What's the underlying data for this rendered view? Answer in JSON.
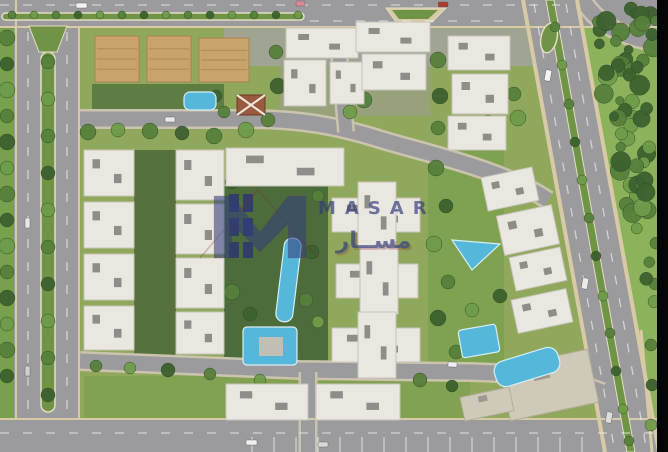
{
  "title": "Residential compound aerial masterplan render",
  "watermark": {
    "brand_en": "MASAR",
    "brand_ar": "مســار",
    "color": "#333d7d",
    "accent": "#8a2430"
  },
  "palette": {
    "asphalt": "#9b9b9d",
    "casing": "#cbc3ad",
    "sidewalk": "#d9caa6",
    "median": "#6f9446",
    "medianEdge": "#e4dcc6",
    "treeDark": "#3d612f",
    "treeMid": "#57803c",
    "treeLight": "#6f9c4a",
    "building": "#e9e7e0",
    "buildingEdge": "#c6c3ba",
    "roofUnit": "#8f8d87",
    "tanRoof": "#c9a36b",
    "tanEdge": "#a9854d",
    "flatRoof": "#cfc9ba",
    "flatEdge": "#b5ad9a",
    "pool": "#55b8da",
    "poolEdge": "#d6eef5",
    "deck": "#c2beb4",
    "cabana": "#2f3a6d",
    "pavilion": "#9a5a40",
    "black": "#050505"
  },
  "scene": {
    "ground": {
      "base": "#90a85c",
      "patches": [
        {
          "x": 0,
          "y": 27,
          "w": 16,
          "h": 393,
          "f": "#79a04c"
        },
        {
          "x": 224,
          "y": 20,
          "w": 312,
          "h": 46,
          "f": "#a3a39b",
          "o": 0.85
        },
        {
          "x": 280,
          "y": 60,
          "w": 150,
          "h": 56,
          "f": "#9c9c94",
          "o": 0.55
        },
        {
          "x": 224,
          "y": 186,
          "w": 104,
          "h": 182,
          "f": "#4d6c3b"
        },
        {
          "x": 92,
          "y": 84,
          "w": 132,
          "h": 36,
          "f": "#5d7d44"
        },
        {
          "x": 134,
          "y": 150,
          "w": 42,
          "h": 206,
          "f": "#56713d"
        },
        {
          "x": 84,
          "y": 376,
          "w": 386,
          "h": 42,
          "f": "#83a251"
        },
        {
          "x": 428,
          "y": 148,
          "w": 76,
          "h": 224,
          "f": "#7ea24f"
        }
      ]
    },
    "rightLawn": {
      "pts": "578,0 668,0 668,452 658,452",
      "f": "#8cb35c"
    },
    "roads": {
      "rects": [
        {
          "x": 0,
          "y": 0,
          "w": 668,
          "h": 26
        },
        {
          "x": 14,
          "y": 0,
          "w": 66,
          "h": 452
        },
        {
          "x": 0,
          "y": 420,
          "w": 668,
          "h": 32
        }
      ],
      "polys": [
        {
          "pts": "522,0 578,0 660,452 604,452"
        }
      ],
      "paths": [
        {
          "d": "M80,119 H246 C304,119 340,127 376,138 C420,152 500,168 548,200",
          "w": 15
        },
        {
          "d": "M80,361 L300,370 L470,372 C538,374 572,380 602,392",
          "w": 15
        },
        {
          "d": "M339,52 L346,132",
          "w": 13
        },
        {
          "d": "M308,372 L308,452",
          "w": 14
        },
        {
          "d": "M584,2 C600,26 626,40 668,44",
          "w": 15
        }
      ]
    },
    "sidewalks": [
      {
        "x1": 0,
        "y1": 27,
        "x2": 668,
        "y2": 27,
        "w": 2
      },
      {
        "x1": 16,
        "y1": 0,
        "x2": 16,
        "y2": 420,
        "w": 2
      },
      {
        "x1": 79,
        "y1": 27,
        "x2": 79,
        "y2": 420,
        "w": 2
      },
      {
        "x1": 0,
        "y1": 419,
        "x2": 668,
        "y2": 419,
        "w": 2
      },
      {
        "x1": 523,
        "y1": 0,
        "x2": 605,
        "y2": 452,
        "w": 4
      },
      {
        "x1": 577,
        "y1": 0,
        "x2": 659,
        "y2": 452,
        "w": 4
      },
      {
        "x1": 641,
        "y1": 330,
        "x2": 652,
        "y2": 452,
        "w": 3
      }
    ],
    "medians": {
      "rects": [
        {
          "x": 41,
          "y": 52,
          "w": 14,
          "h": 360,
          "rx": 7
        },
        {
          "x": 2,
          "y": 13,
          "w": 302,
          "h": 7,
          "rx": 3.5
        }
      ],
      "polys": [
        {
          "pts": "546,0 554,0 635,452 627,452"
        },
        {
          "pts": "29,26 67,26 57,52 39,52"
        }
      ],
      "island": {
        "outer": "386,8 446,8 432,22 396,22",
        "inner": "392,10 438,10 428,19 399,19"
      },
      "teardrop": {
        "cx": 549,
        "cy": 38,
        "rx": 8,
        "ry": 15,
        "rot": 12
      }
    },
    "dashes": [
      {
        "x1": 0,
        "y1": 5,
        "x2": 560,
        "y2": 5
      },
      {
        "x1": 310,
        "y1": 21,
        "x2": 505,
        "y2": 21
      },
      {
        "x1": 28,
        "y1": 32,
        "x2": 28,
        "y2": 414
      },
      {
        "x1": 67,
        "y1": 32,
        "x2": 67,
        "y2": 414
      },
      {
        "x1": 0,
        "y1": 433,
        "x2": 668,
        "y2": 433
      },
      {
        "x1": 534,
        "y1": 4,
        "x2": 615,
        "y2": 452
      },
      {
        "x1": 566,
        "y1": 4,
        "x2": 647,
        "y2": 452
      }
    ],
    "parking": {
      "x0": 252,
      "step": 22,
      "n": 16,
      "y1": 437,
      "y2": 452
    },
    "trees": [
      [
        7,
        38,
        8,
        1
      ],
      [
        7,
        64,
        7,
        0
      ],
      [
        7,
        90,
        8,
        2
      ],
      [
        7,
        116,
        7,
        1
      ],
      [
        7,
        142,
        8,
        0
      ],
      [
        7,
        168,
        7,
        2
      ],
      [
        7,
        194,
        8,
        1
      ],
      [
        7,
        220,
        7,
        0
      ],
      [
        7,
        246,
        8,
        2
      ],
      [
        7,
        272,
        7,
        1
      ],
      [
        7,
        298,
        8,
        0
      ],
      [
        7,
        324,
        7,
        2
      ],
      [
        7,
        350,
        8,
        1
      ],
      [
        7,
        376,
        7,
        0
      ],
      [
        48,
        62,
        7,
        1
      ],
      [
        48,
        99,
        7,
        2
      ],
      [
        48,
        136,
        7,
        1
      ],
      [
        48,
        173,
        7,
        0
      ],
      [
        48,
        210,
        7,
        2
      ],
      [
        48,
        247,
        7,
        1
      ],
      [
        48,
        284,
        7,
        0
      ],
      [
        48,
        321,
        7,
        2
      ],
      [
        48,
        358,
        7,
        1
      ],
      [
        48,
        395,
        7,
        0
      ],
      [
        12,
        15,
        4,
        1
      ],
      [
        34,
        15,
        4,
        2
      ],
      [
        56,
        15,
        4,
        1
      ],
      [
        78,
        15,
        4,
        0
      ],
      [
        100,
        15,
        4,
        2
      ],
      [
        122,
        15,
        4,
        1
      ],
      [
        144,
        15,
        4,
        0
      ],
      [
        166,
        15,
        4,
        2
      ],
      [
        188,
        15,
        4,
        1
      ],
      [
        210,
        15,
        4,
        0
      ],
      [
        232,
        15,
        4,
        2
      ],
      [
        254,
        15,
        4,
        1
      ],
      [
        276,
        15,
        4,
        0
      ],
      [
        298,
        15,
        4,
        2
      ],
      [
        555,
        27,
        5,
        1
      ],
      [
        562,
        65,
        5,
        2
      ],
      [
        569,
        104,
        5,
        1
      ],
      [
        575,
        142,
        5,
        0
      ],
      [
        582,
        180,
        5,
        2
      ],
      [
        589,
        218,
        5,
        1
      ],
      [
        596,
        256,
        5,
        0
      ],
      [
        603,
        296,
        5,
        2
      ],
      [
        610,
        333,
        5,
        1
      ],
      [
        616,
        371,
        5,
        0
      ],
      [
        623,
        409,
        5,
        2
      ],
      [
        629,
        441,
        5,
        1
      ],
      [
        88,
        132,
        8,
        1
      ],
      [
        118,
        130,
        7,
        2
      ],
      [
        150,
        131,
        8,
        1
      ],
      [
        182,
        133,
        7,
        0
      ],
      [
        214,
        136,
        8,
        1
      ],
      [
        246,
        130,
        8,
        2
      ],
      [
        268,
        120,
        7,
        1
      ],
      [
        258,
        106,
        6,
        0
      ],
      [
        276,
        52,
        7,
        1
      ],
      [
        278,
        86,
        8,
        0
      ],
      [
        364,
        100,
        8,
        1
      ],
      [
        350,
        112,
        7,
        2
      ],
      [
        438,
        60,
        8,
        1
      ],
      [
        440,
        96,
        8,
        0
      ],
      [
        438,
        128,
        7,
        1
      ],
      [
        518,
        118,
        8,
        2
      ],
      [
        514,
        94,
        7,
        1
      ],
      [
        488,
        122,
        7,
        0
      ],
      [
        474,
        88,
        7,
        2
      ],
      [
        232,
        182,
        7,
        0
      ],
      [
        318,
        196,
        6,
        1
      ],
      [
        312,
        252,
        7,
        0
      ],
      [
        306,
        300,
        7,
        1
      ],
      [
        250,
        314,
        7,
        0
      ],
      [
        232,
        292,
        8,
        1
      ],
      [
        318,
        322,
        6,
        2
      ],
      [
        436,
        168,
        8,
        1
      ],
      [
        446,
        206,
        7,
        0
      ],
      [
        434,
        244,
        8,
        2
      ],
      [
        448,
        282,
        7,
        1
      ],
      [
        438,
        318,
        8,
        0
      ],
      [
        456,
        352,
        7,
        1
      ],
      [
        472,
        310,
        7,
        2
      ],
      [
        500,
        296,
        7,
        0
      ],
      [
        96,
        366,
        6,
        1
      ],
      [
        130,
        368,
        6,
        2
      ],
      [
        168,
        370,
        7,
        0
      ],
      [
        210,
        374,
        6,
        1
      ],
      [
        260,
        380,
        6,
        2
      ],
      [
        420,
        380,
        7,
        1
      ],
      [
        452,
        386,
        6,
        0
      ],
      [
        651,
        345,
        6,
        1
      ],
      [
        652,
        385,
        6,
        0
      ],
      [
        651,
        425,
        6,
        2
      ],
      [
        216,
        96,
        6,
        0
      ],
      [
        224,
        112,
        6,
        1
      ]
    ],
    "forest": {
      "poly": [
        [
          586,
          8
        ],
        [
          656,
          8
        ],
        [
          656,
          328
        ],
        [
          626,
          210
        ],
        [
          596,
          70
        ]
      ],
      "count": 64,
      "seed": 9,
      "rmin": 4,
      "rmax": 10
    },
    "buildings": [
      {
        "x": 95,
        "y": 36,
        "w": 44,
        "h": 46,
        "s": "t"
      },
      {
        "x": 147,
        "y": 36,
        "w": 44,
        "h": 46,
        "s": "t"
      },
      {
        "x": 199,
        "y": 38,
        "w": 50,
        "h": 44,
        "s": "t"
      },
      {
        "x": 286,
        "y": 28,
        "w": 72,
        "h": 30,
        "s": "w"
      },
      {
        "x": 284,
        "y": 60,
        "w": 42,
        "h": 46,
        "s": "w"
      },
      {
        "x": 330,
        "y": 62,
        "w": 34,
        "h": 42,
        "s": "w"
      },
      {
        "x": 356,
        "y": 22,
        "w": 74,
        "h": 30,
        "s": "w"
      },
      {
        "x": 362,
        "y": 54,
        "w": 64,
        "h": 36,
        "s": "w"
      },
      {
        "x": 448,
        "y": 36,
        "w": 62,
        "h": 34,
        "s": "w"
      },
      {
        "x": 452,
        "y": 74,
        "w": 56,
        "h": 40,
        "s": "w"
      },
      {
        "x": 448,
        "y": 116,
        "w": 58,
        "h": 34,
        "s": "w"
      },
      {
        "x": 84,
        "y": 150,
        "w": 50,
        "h": 46,
        "s": "w"
      },
      {
        "x": 84,
        "y": 202,
        "w": 50,
        "h": 46,
        "s": "w"
      },
      {
        "x": 84,
        "y": 254,
        "w": 50,
        "h": 46,
        "s": "w"
      },
      {
        "x": 84,
        "y": 306,
        "w": 50,
        "h": 44,
        "s": "w"
      },
      {
        "x": 176,
        "y": 150,
        "w": 48,
        "h": 50,
        "s": "w"
      },
      {
        "x": 176,
        "y": 204,
        "w": 48,
        "h": 50,
        "s": "w"
      },
      {
        "x": 176,
        "y": 258,
        "w": 48,
        "h": 50,
        "s": "w"
      },
      {
        "x": 176,
        "y": 312,
        "w": 48,
        "h": 42,
        "s": "w"
      },
      {
        "x": 226,
        "y": 148,
        "w": 118,
        "h": 38,
        "s": "w"
      },
      {
        "x": 332,
        "y": 198,
        "w": 88,
        "h": 34,
        "s": "w"
      },
      {
        "x": 358,
        "y": 182,
        "w": 38,
        "h": 66,
        "s": "w"
      },
      {
        "x": 336,
        "y": 264,
        "w": 82,
        "h": 34,
        "s": "w"
      },
      {
        "x": 360,
        "y": 248,
        "w": 38,
        "h": 66,
        "s": "w"
      },
      {
        "x": 332,
        "y": 328,
        "w": 88,
        "h": 34,
        "s": "w"
      },
      {
        "x": 358,
        "y": 312,
        "w": 38,
        "h": 66,
        "s": "w"
      },
      {
        "x": 484,
        "y": 172,
        "w": 52,
        "h": 34,
        "s": "w",
        "rot": -12
      },
      {
        "x": 500,
        "y": 210,
        "w": 56,
        "h": 40,
        "s": "w",
        "rot": -12
      },
      {
        "x": 512,
        "y": 252,
        "w": 52,
        "h": 34,
        "s": "w",
        "rot": -12
      },
      {
        "x": 514,
        "y": 294,
        "w": 56,
        "h": 34,
        "s": "w",
        "rot": -12
      },
      {
        "x": 504,
        "y": 358,
        "w": 90,
        "h": 54,
        "s": "f",
        "rot": -12
      },
      {
        "x": 462,
        "y": 392,
        "w": 50,
        "h": 24,
        "s": "f",
        "rot": -12
      },
      {
        "x": 226,
        "y": 384,
        "w": 82,
        "h": 36,
        "s": "w"
      },
      {
        "x": 316,
        "y": 384,
        "w": 84,
        "h": 36,
        "s": "w"
      }
    ],
    "pools": [
      {
        "t": "r",
        "x": 184,
        "y": 92,
        "w": 32,
        "h": 18,
        "rx": 6
      },
      {
        "t": "r",
        "x": 280,
        "y": 238,
        "w": 17,
        "h": 84,
        "rx": 8,
        "rot": 7
      },
      {
        "t": "r",
        "x": 243,
        "y": 327,
        "w": 54,
        "h": 38,
        "rx": 4,
        "deck": {
          "x": 259,
          "y": 337,
          "w": 24,
          "h": 19
        }
      },
      {
        "t": "p",
        "pts": "452,240 500,244 472,270"
      },
      {
        "t": "r",
        "x": 460,
        "y": 327,
        "w": 38,
        "h": 28,
        "rx": 3,
        "rot": -10
      },
      {
        "t": "r",
        "x": 494,
        "y": 354,
        "w": 66,
        "h": 26,
        "rx": 10,
        "rot": -17
      }
    ],
    "cabanas": [
      [
        229,
        194,
        10,
        18
      ],
      [
        243,
        194,
        10,
        18
      ],
      [
        229,
        218,
        10,
        18
      ],
      [
        243,
        218,
        10,
        18
      ],
      [
        229,
        242,
        10,
        16
      ],
      [
        243,
        242,
        10,
        16
      ]
    ],
    "pavilion": {
      "x": 237,
      "y": 95,
      "w": 28,
      "h": 20
    },
    "cars": [
      [
        76,
        3,
        11,
        5,
        "#f2f2f2",
        0
      ],
      [
        296,
        1,
        9,
        5,
        "#d98a94",
        0
      ],
      [
        438,
        2,
        10,
        5,
        "#b03a30",
        0
      ],
      [
        165,
        117,
        10,
        5,
        "#e8e8e8",
        0
      ],
      [
        25,
        218,
        5,
        10,
        "#e8e8e8",
        0
      ],
      [
        25,
        366,
        5,
        10,
        "#cfcfcf",
        0
      ],
      [
        545,
        70,
        6,
        11,
        "#f4f4f4",
        10
      ],
      [
        582,
        278,
        6,
        11,
        "#ececec",
        10
      ],
      [
        606,
        412,
        6,
        11,
        "#dedede",
        10
      ],
      [
        246,
        440,
        11,
        5,
        "#f0f0f0",
        0
      ],
      [
        318,
        442,
        10,
        5,
        "#d8d8d8",
        0
      ],
      [
        448,
        362,
        9,
        5,
        "#efefef",
        2
      ]
    ],
    "edgeBar": {
      "x": 657,
      "y": 0,
      "w": 11,
      "h": 452
    }
  }
}
